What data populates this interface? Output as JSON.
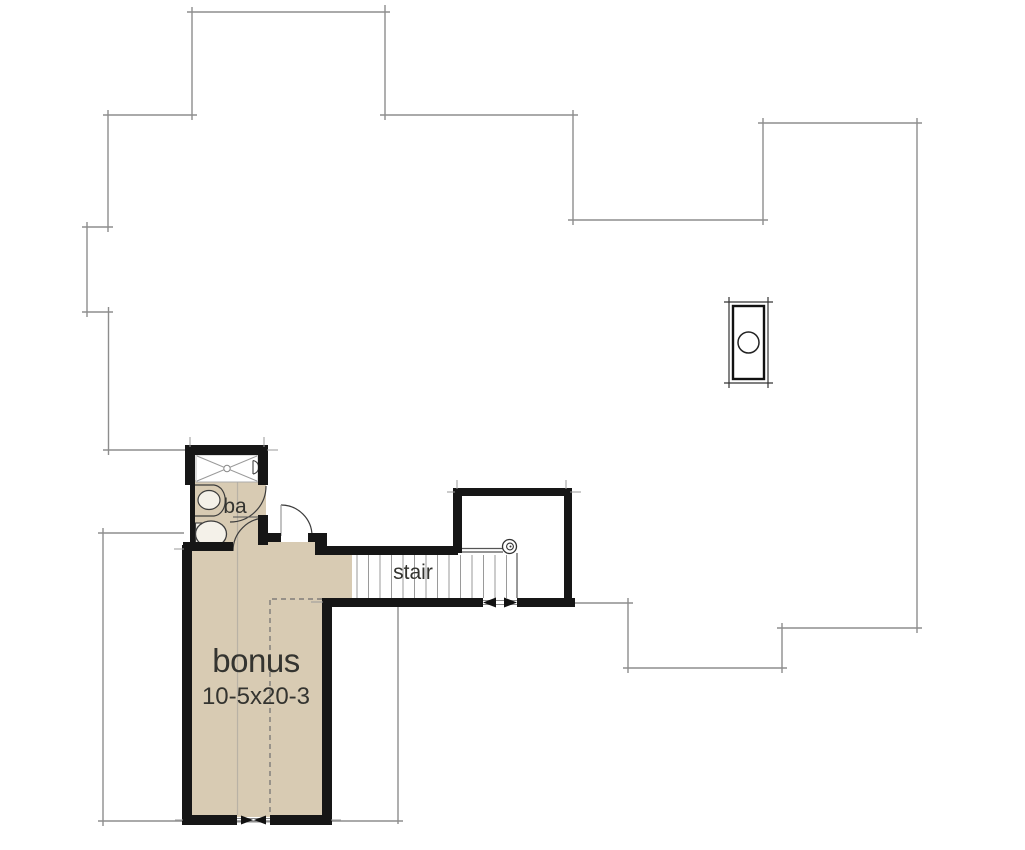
{
  "labels": {
    "bonus_room": "bonus",
    "bonus_dimensions": "10-5x20-3",
    "stair": "stair",
    "bath": "ba"
  },
  "colors": {
    "floor_fill": "#d8cbb3",
    "wall": "#161616",
    "roofline": "#8d8d8d",
    "text": "#343430",
    "fixture_line": "#3c3c3c",
    "tread_line": "#9a9a9a"
  }
}
